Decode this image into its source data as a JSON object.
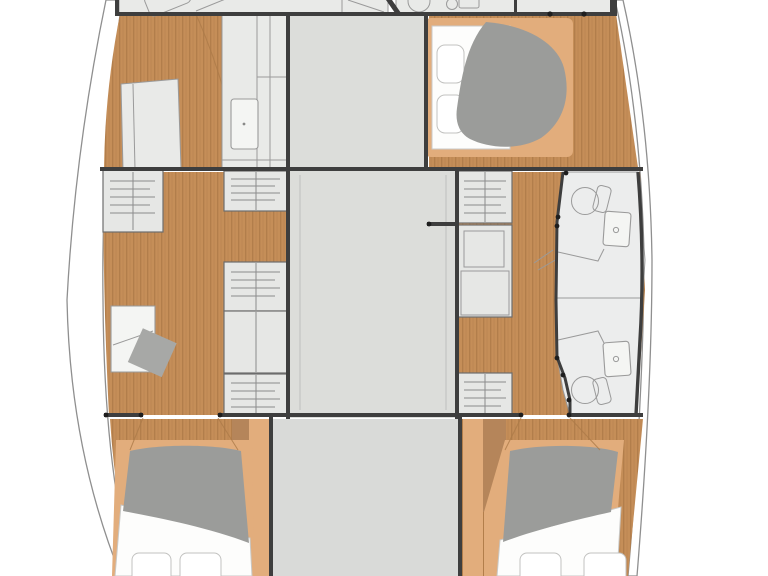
{
  "title": "Catamaran interior layout floor plan (top view, no text labels)",
  "plan": {
    "type": "catamaran-floor-plan",
    "orientation": "bows toward bottom of image, image cropped top and bottom",
    "port_hull": {
      "aft_head_partial": {
        "fixtures": [
          "vanity",
          "sink"
        ]
      },
      "lounge_cabin": {
        "furniture": [
          "side-berth-sofa",
          "galley-counter-with-sink"
        ]
      },
      "office_area": {
        "furniture": [
          "entry-steps",
          "desk",
          "stool"
        ]
      },
      "forward_cabin": {
        "furniture": [
          "double-bed",
          "two-pillows"
        ]
      }
    },
    "starboard_hull": {
      "aft_head_partial": {
        "fixtures": [
          "toilet",
          "sink"
        ]
      },
      "aft_cabin": {
        "furniture": [
          "island-double-bed",
          "two-pillows",
          "duvet"
        ]
      },
      "bathrooms": {
        "count": 2,
        "fixtures": [
          "toilet",
          "washbasin",
          "shower-partition"
        ]
      },
      "forward_cabin": {
        "furniture": [
          "double-bed",
          "two-pillows"
        ]
      }
    },
    "bridgedeck": {
      "aft_block": "galley / saloon furniture block",
      "saloon": "central open floor",
      "forward_deck": "forward platform between hulls",
      "companionway_steps": {
        "port": 3,
        "starboard": 2
      }
    }
  },
  "colors": {
    "background": "#ffffff",
    "wall": "#3e3e3e",
    "wood": "#c58e58",
    "wood_grain": "#7c4f28",
    "wood_light": "#e2ad7c",
    "wood_dark": "#b5855a",
    "furniture": "#e9eae8",
    "furniture_line": "#9a9a9a",
    "deck": "#dcddda",
    "deck_bottom": "#d9dad8",
    "duvet": "#9b9c9a",
    "mattress": "#fdfdfc",
    "stool": "#a7a8a6",
    "hull_line": "#8f8f8f",
    "bath_floor": "#eceded",
    "step": "#e6e7e5",
    "dot": "#1e1e1e"
  }
}
